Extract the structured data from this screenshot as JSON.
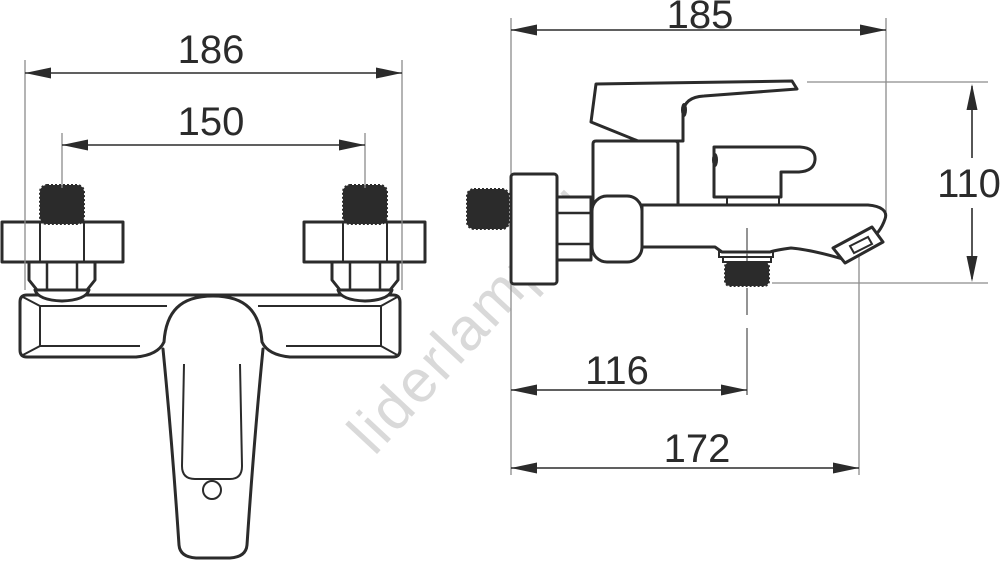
{
  "drawing": {
    "watermark": "liderlamp.pl",
    "colors": {
      "line": "#2b2b2b",
      "extension_line": "#8c8c8c",
      "centerline": "#666666",
      "watermark": "#d9d9d9",
      "background": "#ffffff"
    },
    "front_view": {
      "dim_overall_width": "186",
      "dim_connection_spacing": "150"
    },
    "side_view": {
      "dim_overall_depth": "185",
      "dim_overall_height": "110",
      "dim_outlet_offset": "116",
      "dim_spout_reach": "172"
    }
  }
}
